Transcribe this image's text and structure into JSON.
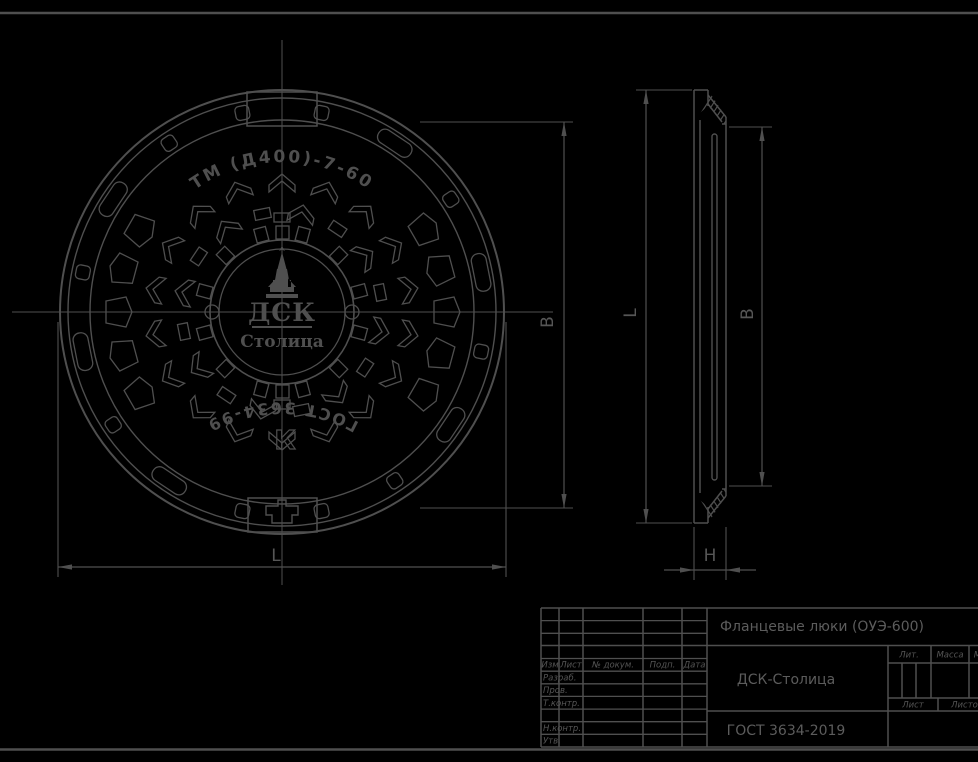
{
  "colors": {
    "background": "#000000",
    "line": "#4f4f4f",
    "text": "#5c5c5c"
  },
  "front_view": {
    "marking_top": "ТМ (Д400)-7-60",
    "marking_bottom": "ГОСТ 3634-99",
    "class_letter": "К",
    "logo": {
      "line1": "ДСК",
      "line2": "Столица"
    }
  },
  "dimensions": {
    "front_outer": "L",
    "front_inner": "В",
    "side_height": "L",
    "side_inner": "В",
    "side_thickness": "Н"
  },
  "title_block": {
    "doc_title": "Фланцевые люки (ОУЭ-600)",
    "company": "ДСК-Столица",
    "standard": "ГОСТ 3634-2019",
    "header_cols": [
      "Изм",
      "Лист",
      "№ докум.",
      "Подп.",
      "Дата"
    ],
    "row_labels": [
      "Разраб.",
      "Пров.",
      "Т.контр.",
      "",
      "Н.контр.",
      "Утв."
    ],
    "right_headers": [
      "Лит.",
      "Масса",
      "Масштаб"
    ],
    "sheet_labels": [
      "Лист",
      "Листов"
    ]
  }
}
